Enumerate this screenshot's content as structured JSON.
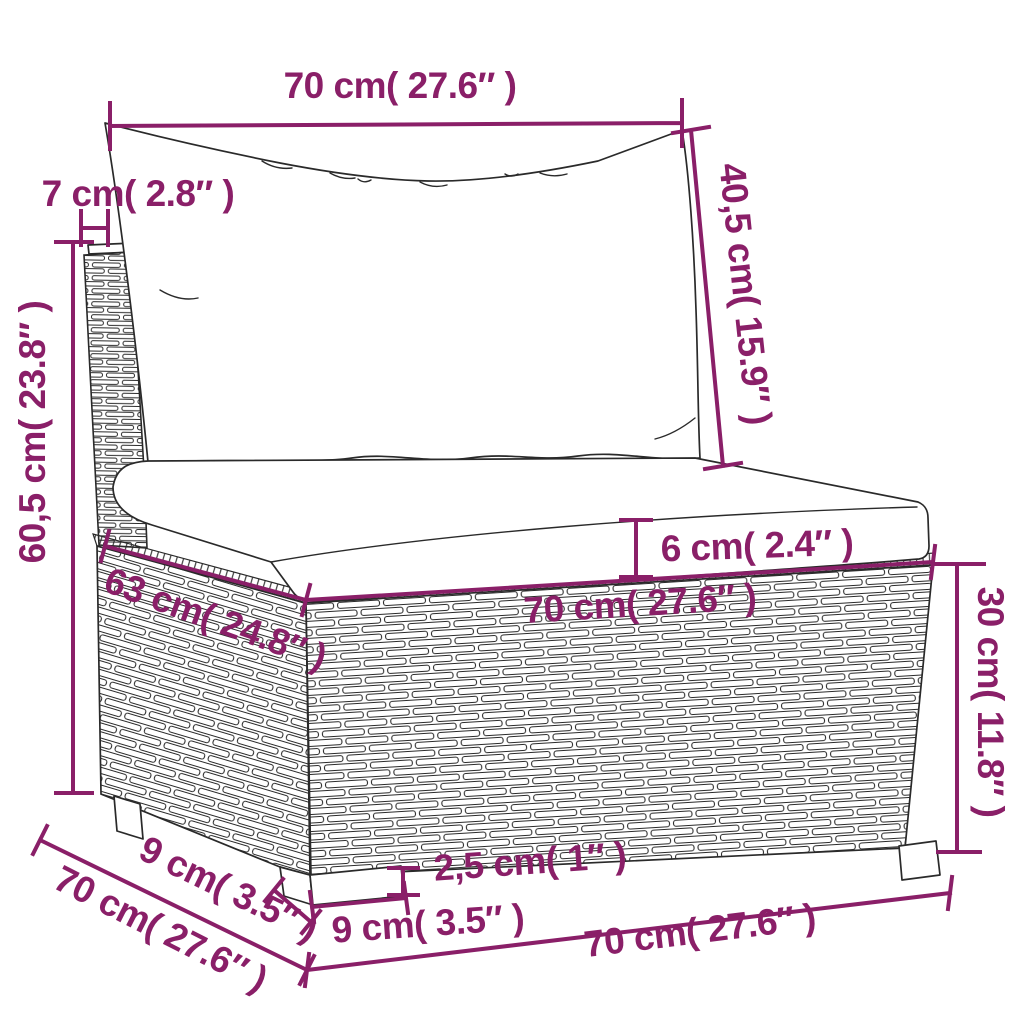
{
  "diagram": {
    "subject": "rattan-garden-middle-sofa-with-cushions",
    "view": "three-quarter perspective technical line drawing"
  },
  "colors": {
    "dimension_accent": "#8A1F68",
    "drawing_outline": "#2A2A2A",
    "background": "#FFFFFF"
  },
  "units": {
    "primary": "cm",
    "secondary": "inches"
  },
  "dimensions": {
    "back_cushion_width": "70 cm( 27.6″ )",
    "back_panel_thickness": "7 cm( 2.8″ )",
    "back_cushion_height": "40,5 cm( 15.9″ )",
    "total_height": "60,5 cm( 23.8″ )",
    "seat_cushion_thickness": "6 cm( 2.4″ )",
    "seat_width": "70 cm( 27.6″ )",
    "seat_depth": "63 cm( 24.8″ )",
    "base_height": "30 cm( 11.8″ )",
    "leg_height": "2,5 cm( 1″ )",
    "leg_front_width": "9 cm( 3.5″ )",
    "leg_side_depth": "9 cm( 3.5″ )",
    "total_depth": "70 cm( 27.6″ )",
    "base_front_width": "70 cm( 27.6″ )"
  }
}
